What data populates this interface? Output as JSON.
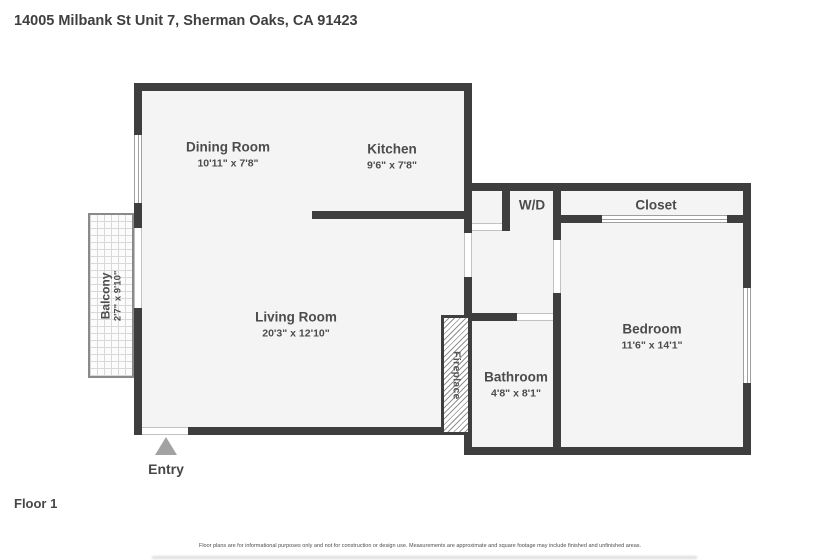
{
  "title": "14005 Milbank St Unit 7, Sherman Oaks, CA 91423",
  "floor_label": "Floor 1",
  "disclaimer": "Floor plans are for informational purposes only and not for construction or design use. Measurements are approximate and square footage may include finished and unfinished areas.",
  "colors": {
    "wall": "#3e3e3e",
    "floor": "#f4f4f4",
    "label_text": "#4c4c4c",
    "entry_marker": "#a2a2a2"
  },
  "rooms": {
    "dining": {
      "name": "Dining Room",
      "dims": "10'11\" x 7'8\""
    },
    "kitchen": {
      "name": "Kitchen",
      "dims": "9'6\" x 7'8\""
    },
    "living": {
      "name": "Living Room",
      "dims": "20'3\" x 12'10\""
    },
    "bedroom": {
      "name": "Bedroom",
      "dims": "11'6\" x 14'1\""
    },
    "bathroom": {
      "name": "Bathroom",
      "dims": "4'8\" x 8'1\""
    },
    "closet": {
      "name": "Closet"
    },
    "washer_dryer": {
      "name": "W/D"
    },
    "balcony": {
      "name": "Balcony",
      "dims": "2'7\" x 9'10\""
    },
    "fireplace": {
      "name": "Fireplace"
    },
    "entry": {
      "name": "Entry"
    }
  }
}
